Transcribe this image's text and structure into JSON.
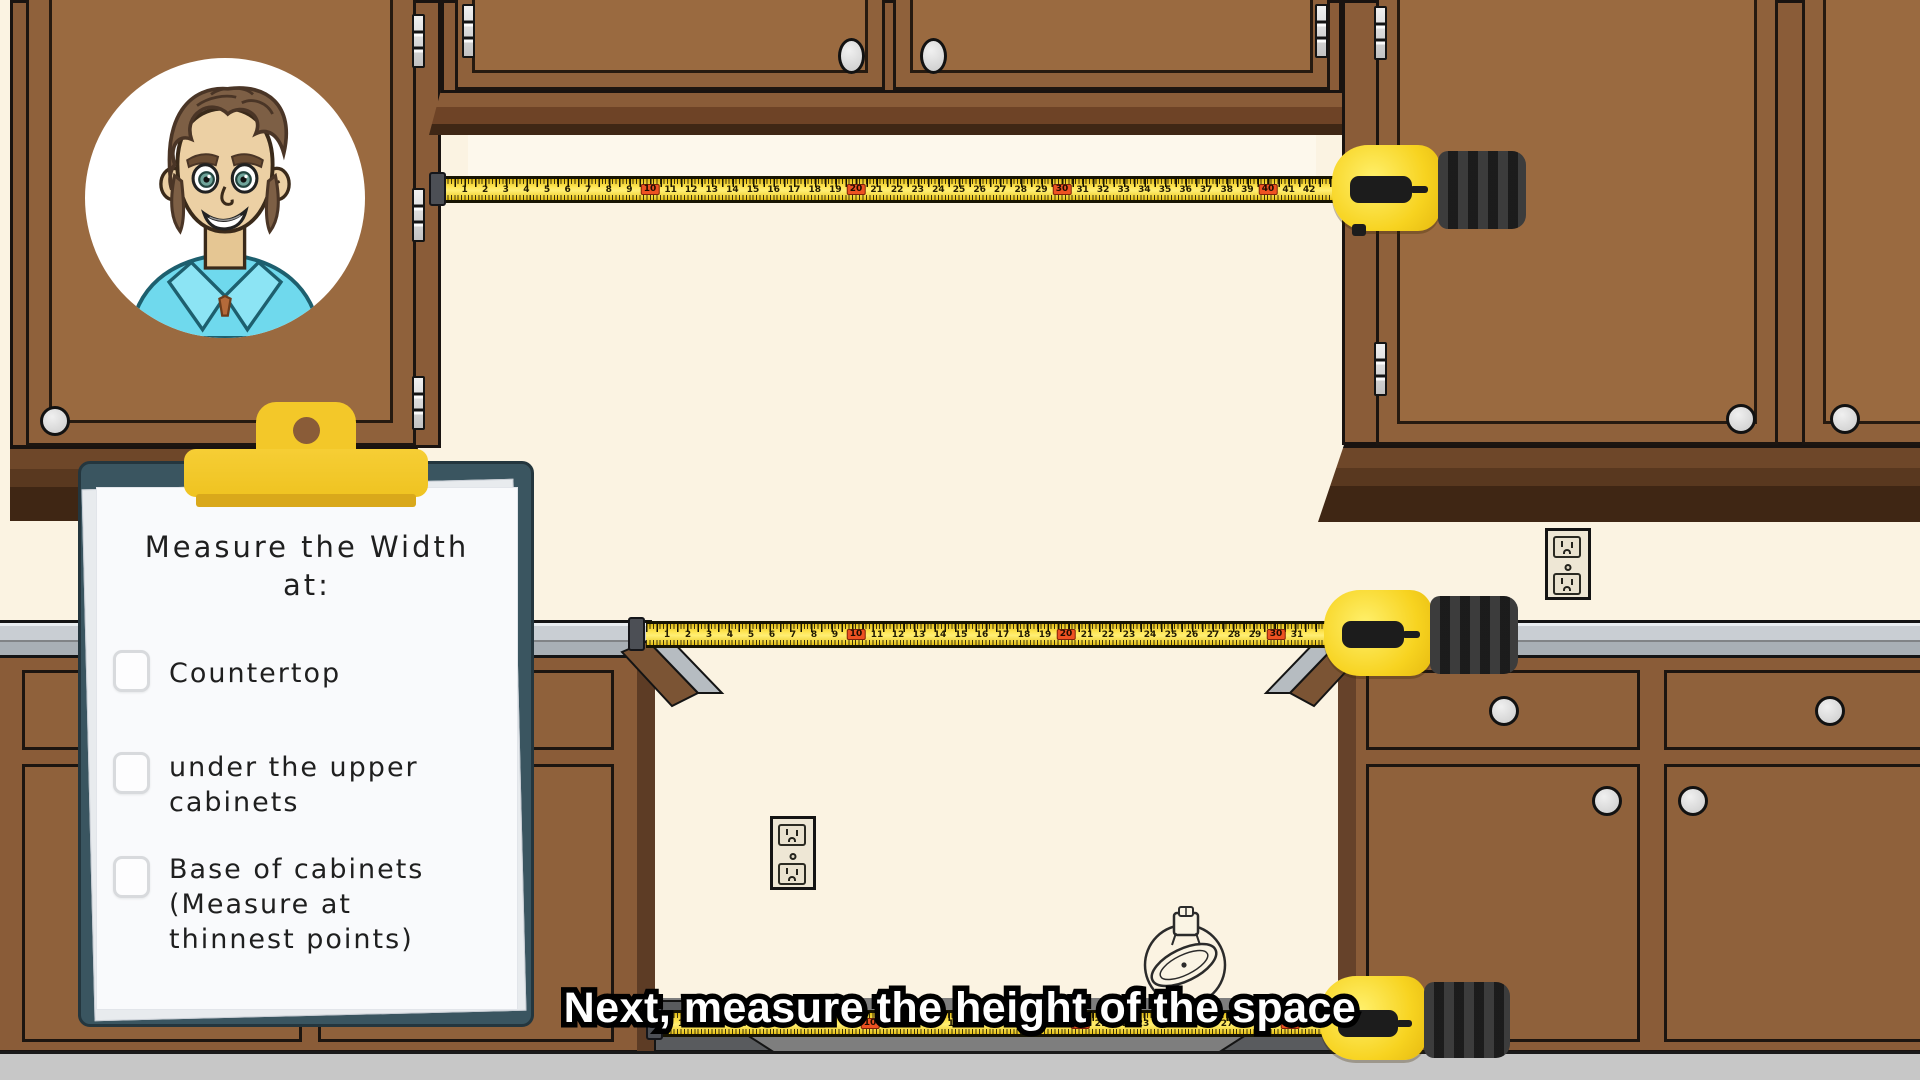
{
  "scene": {
    "caption": "Next, measure the height of the space"
  },
  "clipboard": {
    "title_lines": [
      "Measure the Width",
      "at:"
    ],
    "items": [
      {
        "label_lines": [
          "Countertop",
          "",
          ""
        ],
        "checked": false
      },
      {
        "label_lines": [
          "under the upper",
          "cabinets",
          ""
        ],
        "checked": false
      },
      {
        "label_lines": [
          "Base of cabinets",
          "(Measure at",
          "thinnest points)"
        ],
        "checked": false
      }
    ]
  },
  "tapes": [
    {
      "id": "tape-top",
      "start": 1,
      "unit_px": 20.6,
      "red_every": 10
    },
    {
      "id": "tape-mid",
      "start": 1,
      "unit_px": 21.0,
      "red_every": 10
    },
    {
      "id": "tape-bottom",
      "start": 1,
      "unit_px": 21.0,
      "red_every": 10
    }
  ],
  "colors": {
    "wall": "#fbf3e2",
    "cabinet_brown": "#8a5c38",
    "cabinet_panel": "#9a6a40",
    "countertop_gray": "#c9ced3",
    "tape_yellow": "#f7d320",
    "tape_red_box": "#ee5222",
    "clipboard_board": "#3a5560",
    "clip_yellow": "#f3c829",
    "floor_gray": "#c7c7c7",
    "caption_text": "#ffffff"
  }
}
